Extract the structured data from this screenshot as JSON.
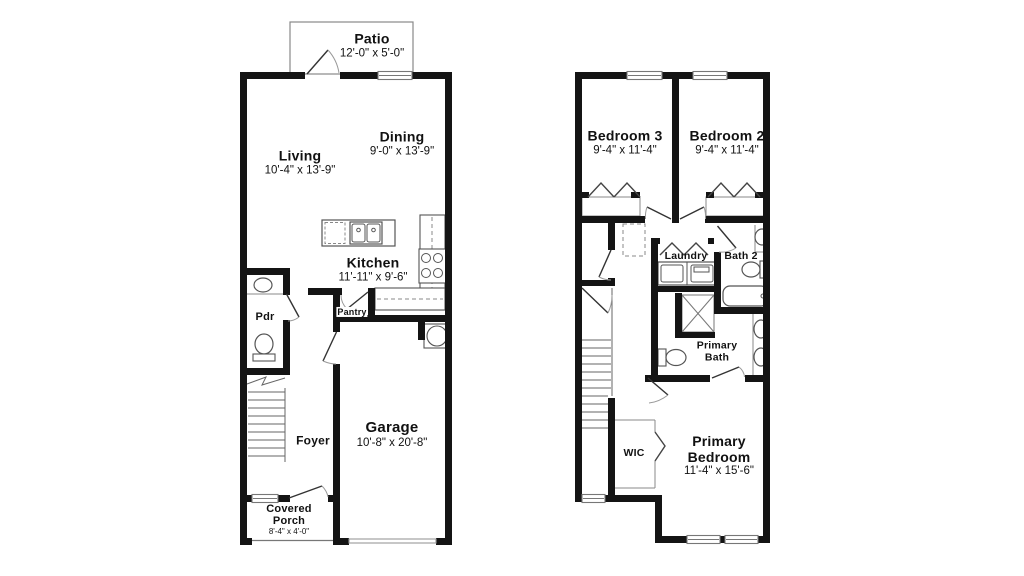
{
  "page": {
    "title": "Two-story townhome floor plan"
  },
  "colors": {
    "wall": "#141414",
    "thin_line": "#666666",
    "fixture_line": "#555555",
    "text": "#111111"
  },
  "floor1": {
    "patio": {
      "name": "Patio",
      "dims": "12'-0\" x 5'-0\""
    },
    "living": {
      "name": "Living",
      "dims": "10'-4\" x 13'-9\""
    },
    "dining": {
      "name": "Dining",
      "dims": "9'-0\" x 13'-9\""
    },
    "kitchen": {
      "name": "Kitchen",
      "dims": "11'-11\" x 9'-6\""
    },
    "pantry": {
      "name": "Pantry"
    },
    "pdr": {
      "name": "Pdr"
    },
    "foyer": {
      "name": "Foyer"
    },
    "garage": {
      "name": "Garage",
      "dims": "10'-8\" x 20'-8\""
    },
    "covered_porch": {
      "name": "Covered Porch",
      "dims": "8'-4\" x 4'-0\""
    }
  },
  "floor2": {
    "bedroom3": {
      "name": "Bedroom 3",
      "dims": "9'-4\" x 11'-4\""
    },
    "bedroom2": {
      "name": "Bedroom 2",
      "dims": "9'-4\" x 11'-4\""
    },
    "laundry": {
      "name": "Laundry"
    },
    "bath2": {
      "name": "Bath 2"
    },
    "primary_bath": {
      "name": "Primary Bath"
    },
    "wic": {
      "name": "WIC"
    },
    "primary_bedroom": {
      "name": "Primary Bedroom",
      "dims": "11'-4\" x 15'-6\""
    }
  }
}
